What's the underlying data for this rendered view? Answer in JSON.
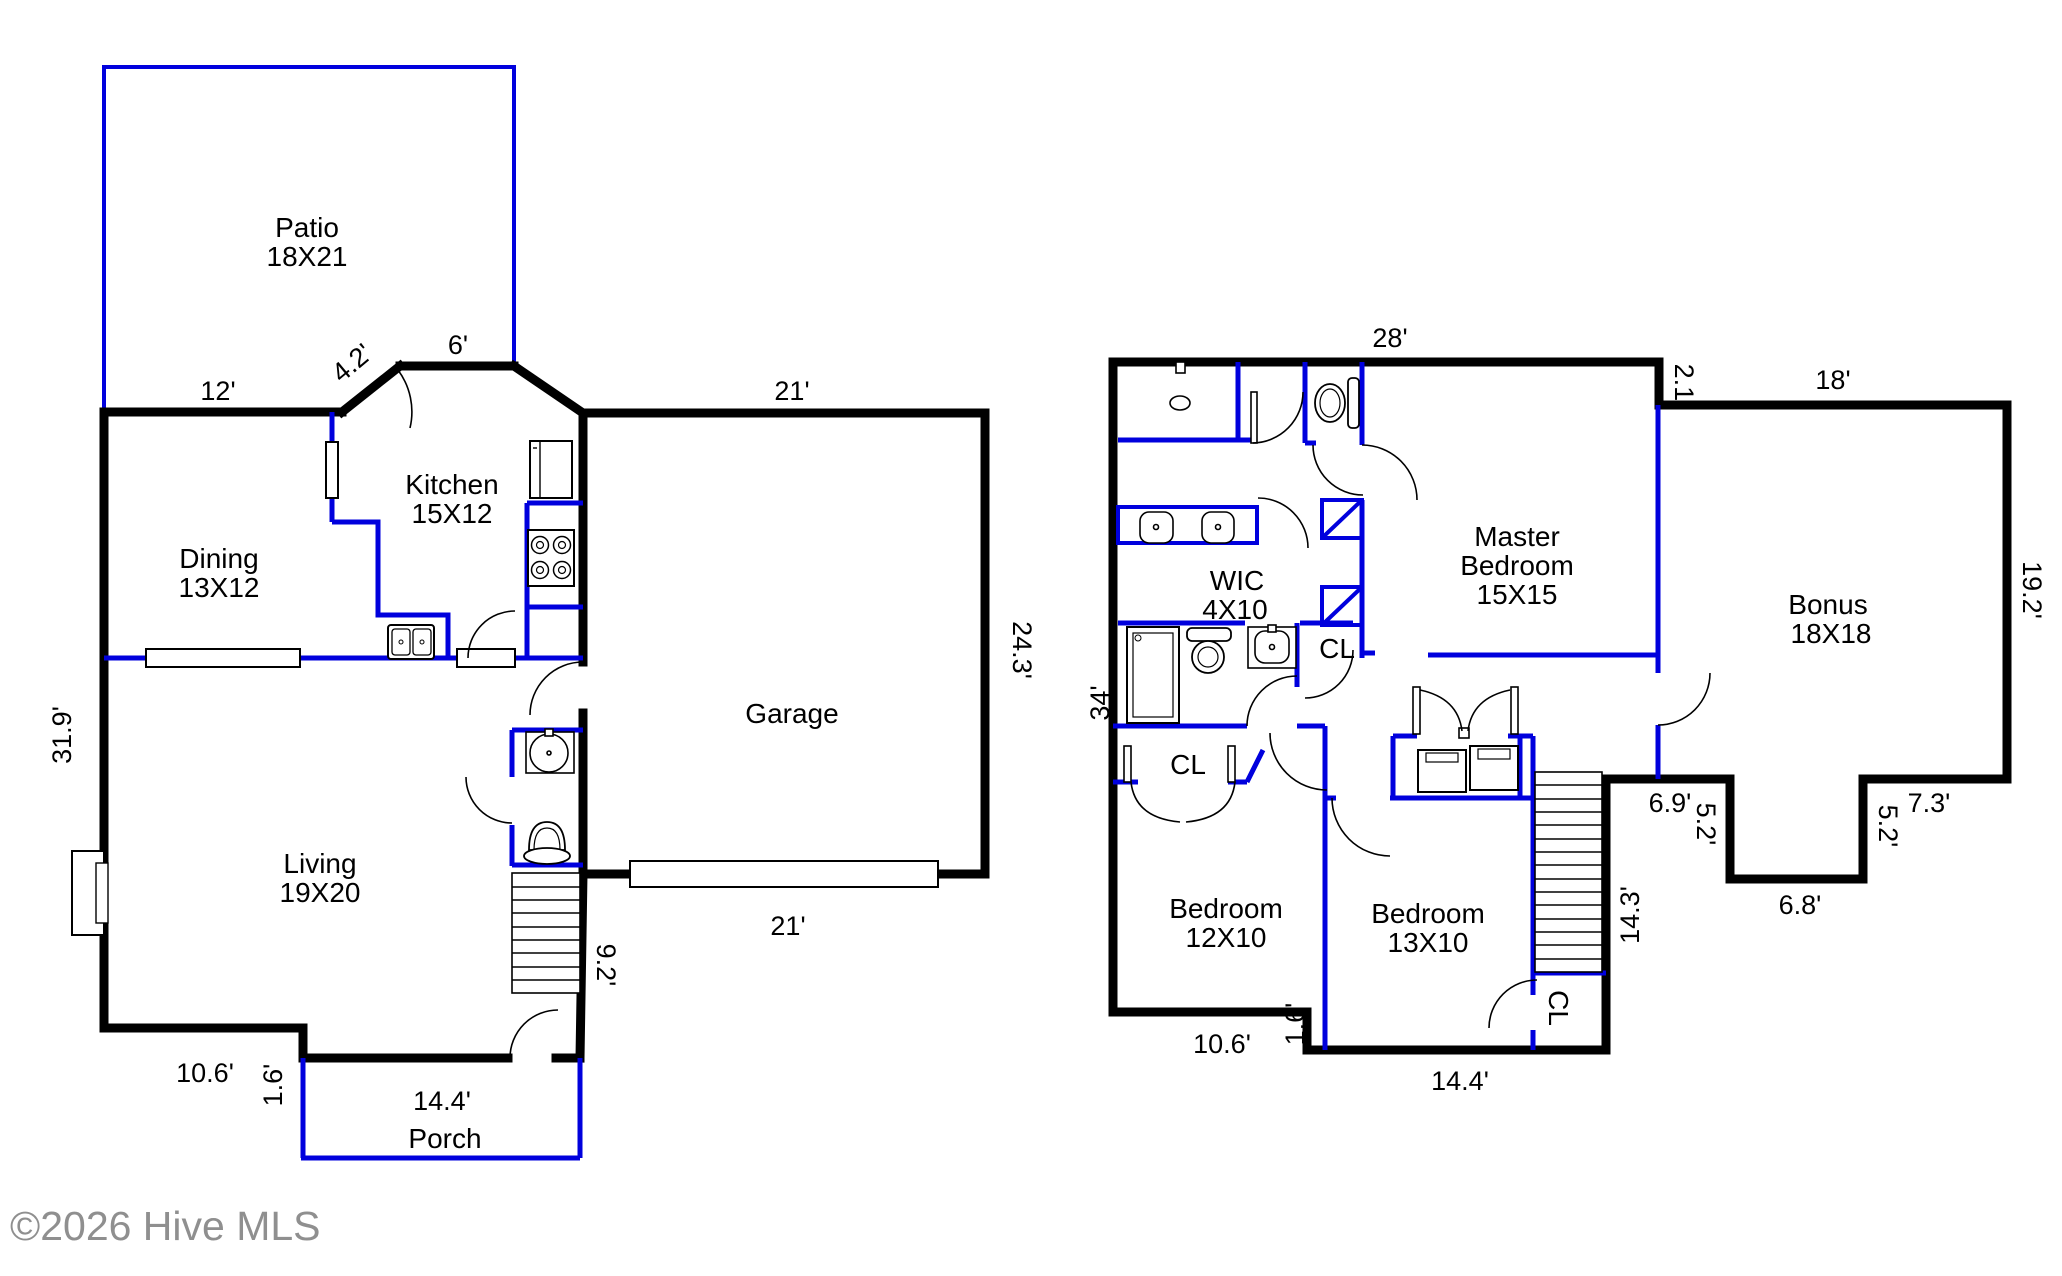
{
  "copyright": "©2026 Hive MLS",
  "floor1": {
    "patio": {
      "name": "Patio",
      "size": "18X21"
    },
    "dining": {
      "name": "Dining",
      "size": "13X12"
    },
    "kitchen": {
      "name": "Kitchen",
      "size": "15X12"
    },
    "garage": {
      "name": "Garage"
    },
    "living": {
      "name": "Living",
      "size": "19X20"
    },
    "porch": {
      "name": "Porch"
    },
    "dims": {
      "top_left": "12'",
      "patio_door": "4.2'",
      "top_mid": "6'",
      "garage_top": "21'",
      "garage_right": "24.3'",
      "garage_door": "21'",
      "left_side": "31.9'",
      "stairs": "9.2'",
      "bottom_left": "10.6'",
      "bottom_step": "1.6'",
      "porch_width": "14.4'"
    }
  },
  "floor2": {
    "master": {
      "name_line1": "Master",
      "name_line2": "Bedroom",
      "size": "15X15"
    },
    "wic": {
      "name": "WIC",
      "size": "4X10"
    },
    "bonus": {
      "name": "Bonus",
      "size": "18X18"
    },
    "bedroom_left": {
      "name": "Bedroom",
      "size": "12X10"
    },
    "bedroom_right": {
      "name": "Bedroom",
      "size": "13X10"
    },
    "closet_hall": "CL",
    "closet_bedroom_left": "CL",
    "closet_stairs": "CL",
    "dims": {
      "top": "28'",
      "master_step": "2.1'",
      "bonus_top": "18'",
      "bonus_right": "19.2'",
      "left_side": "34'",
      "notch_left": "6.9'",
      "notch_left_depth": "5.2'",
      "notch_bottom": "6.8'",
      "notch_right_depth": "5.2'",
      "notch_right": "7.3'",
      "stairs": "14.3'",
      "bottom_left": "10.6'",
      "bottom_step": "1.6'",
      "bottom_right": "14.4'"
    }
  }
}
